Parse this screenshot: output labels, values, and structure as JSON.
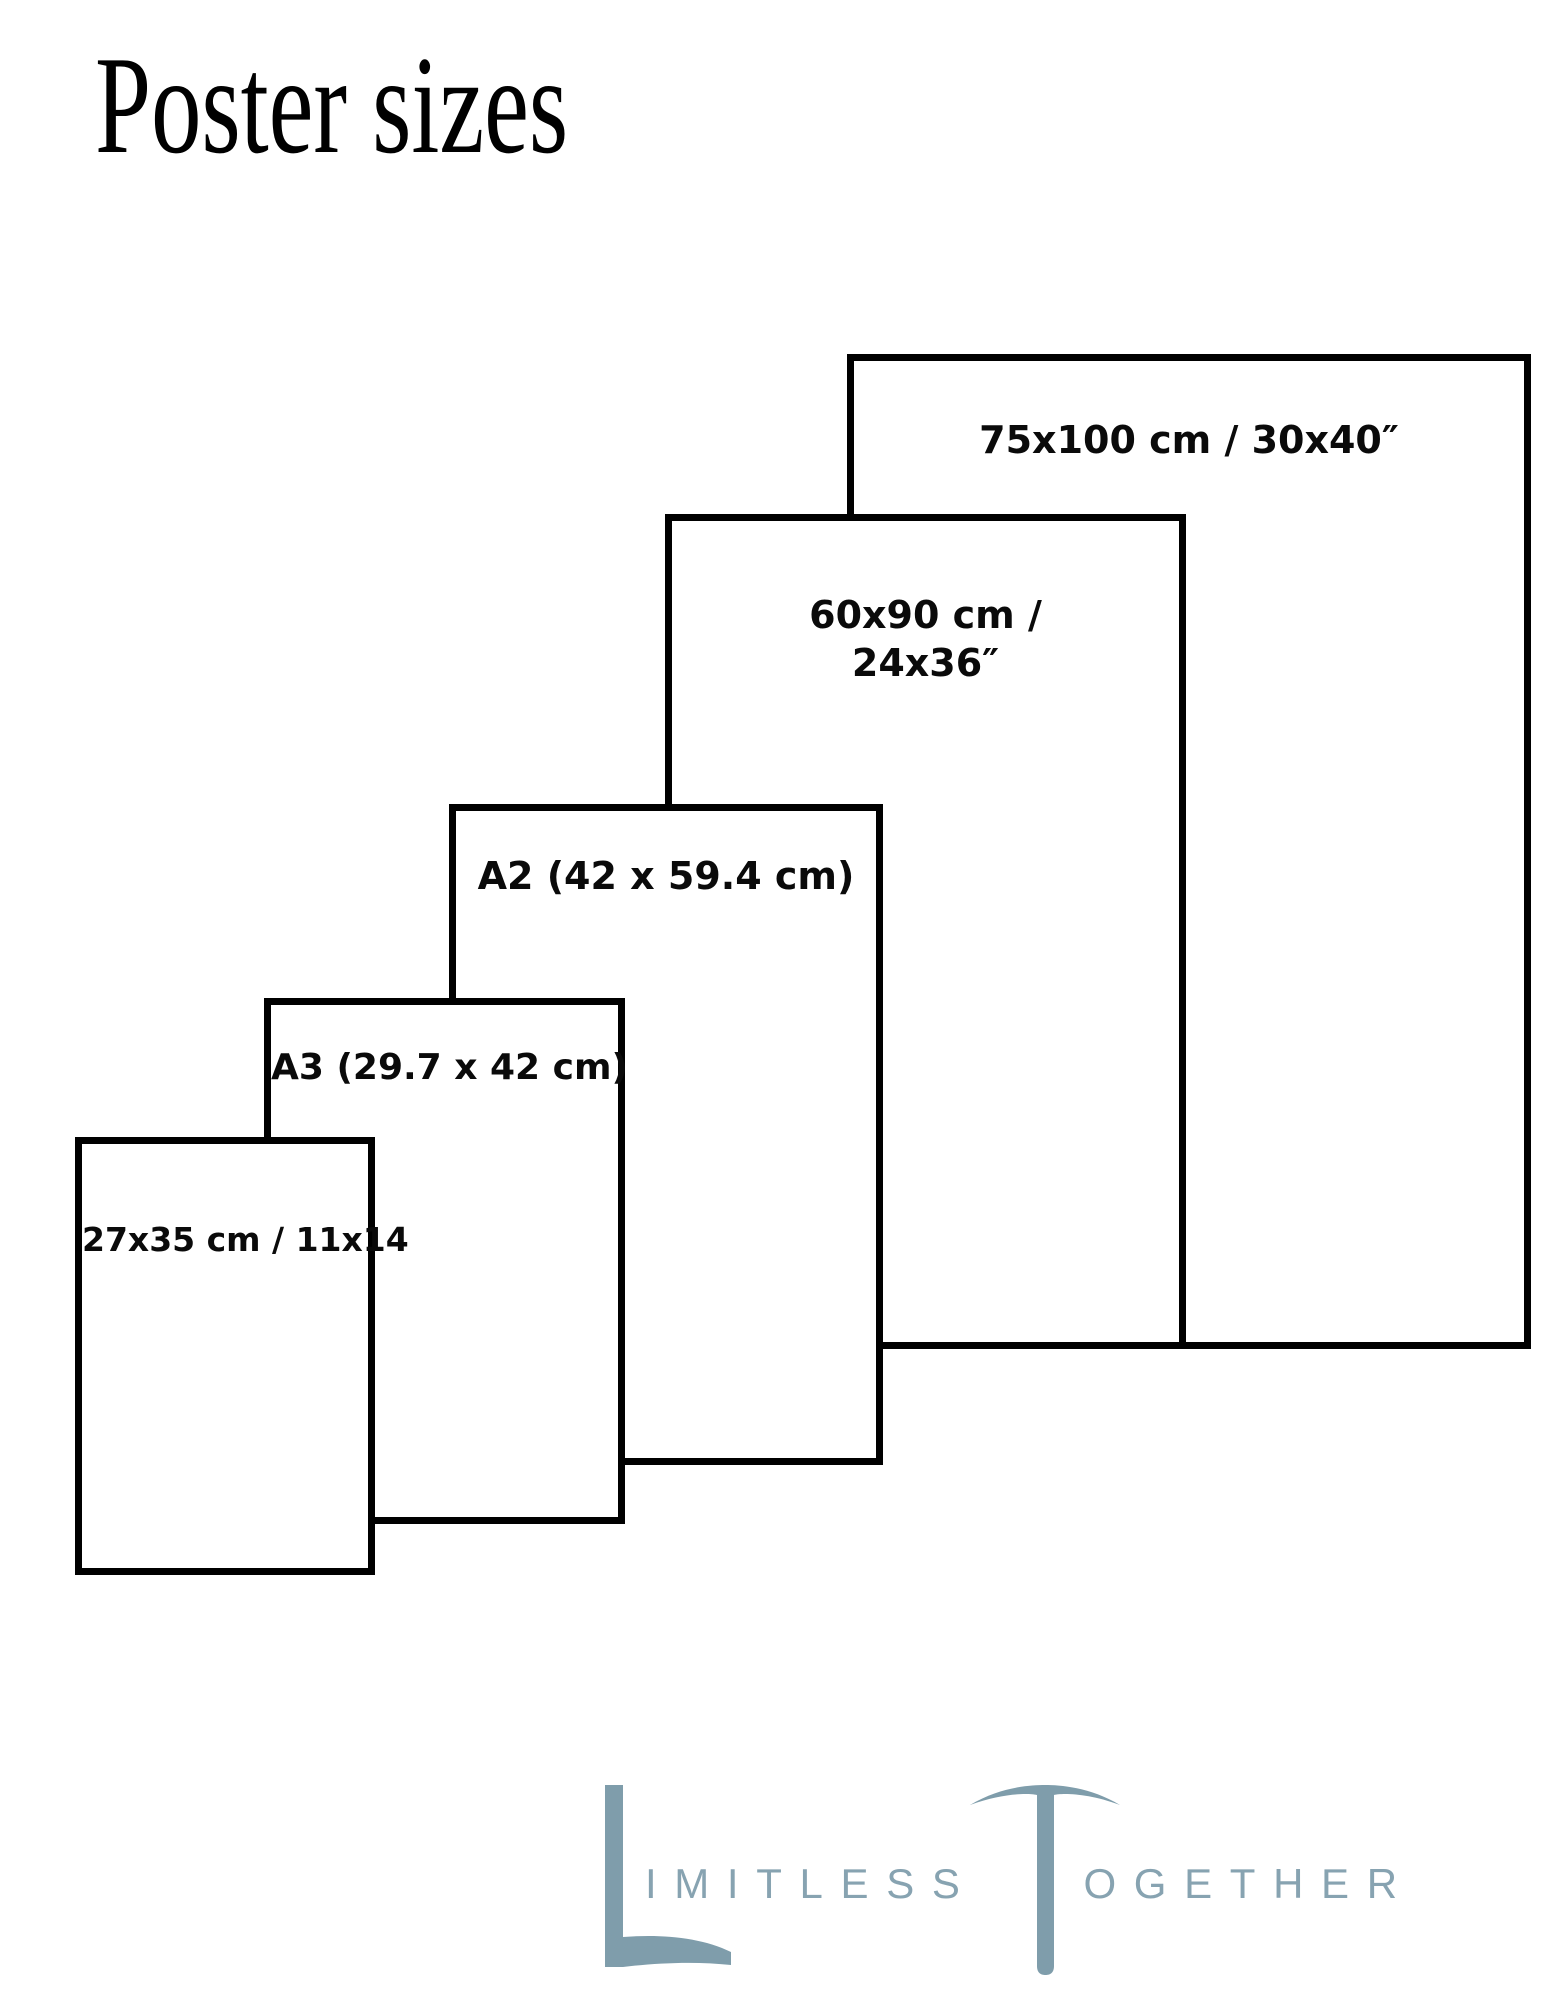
{
  "title": "Poster sizes",
  "sizes": [
    {
      "name": "75x100 cm / 30x40 inch poster",
      "label": "75x100 cm / 30x40″"
    },
    {
      "name": "60x90 cm / 24x36 inch poster",
      "label_line1": "60x90 cm /",
      "label_line2": "24x36″"
    },
    {
      "name": "A2 poster",
      "label": "A2 (42 x 59.4 cm)"
    },
    {
      "name": "A3 poster",
      "label": "A3 (29.7 x 42 cm)"
    },
    {
      "name": "27x35 cm / 11x14 inch poster",
      "label": "27x35 cm / 11x14"
    }
  ],
  "logo": {
    "initial_1": "L",
    "word_1_rest": "IMITLESS",
    "initial_2": "T",
    "word_2_rest": "OGETHER",
    "full_text": "LIMITLESS TOGETHER",
    "color": "#87a3b1"
  },
  "colors": {
    "background": "#ffffff",
    "box_border": "#000000",
    "box_fill": "#ffffff",
    "text": "#0a0a0a"
  }
}
